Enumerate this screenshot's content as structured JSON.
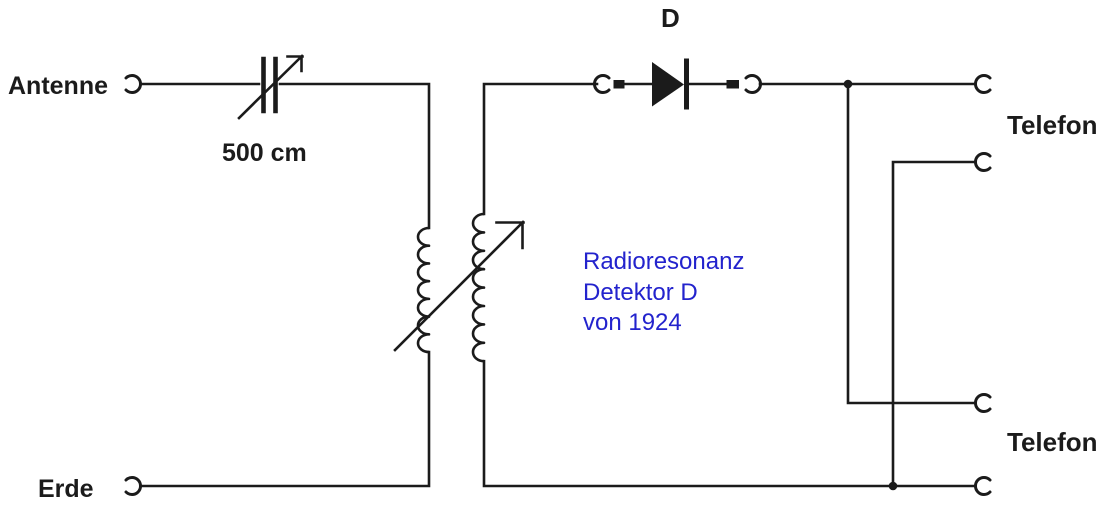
{
  "diagram": {
    "title_hint": "Crystal radio detector circuit schematic",
    "labels": {
      "antenne": "Antenne",
      "capacitor_value": "500 cm",
      "detector": "D",
      "telefon_top": "Telefon",
      "telefon_bottom": "Telefon",
      "erde": "Erde"
    },
    "annotation": {
      "line1": "Radioresonanz",
      "line2": "Detektor D",
      "line3": "von 1924",
      "color": "#2323cd"
    },
    "colors": {
      "wire": "#1b1b1b",
      "background": "#ffffff",
      "annotation_blue": "#2323cd"
    }
  }
}
